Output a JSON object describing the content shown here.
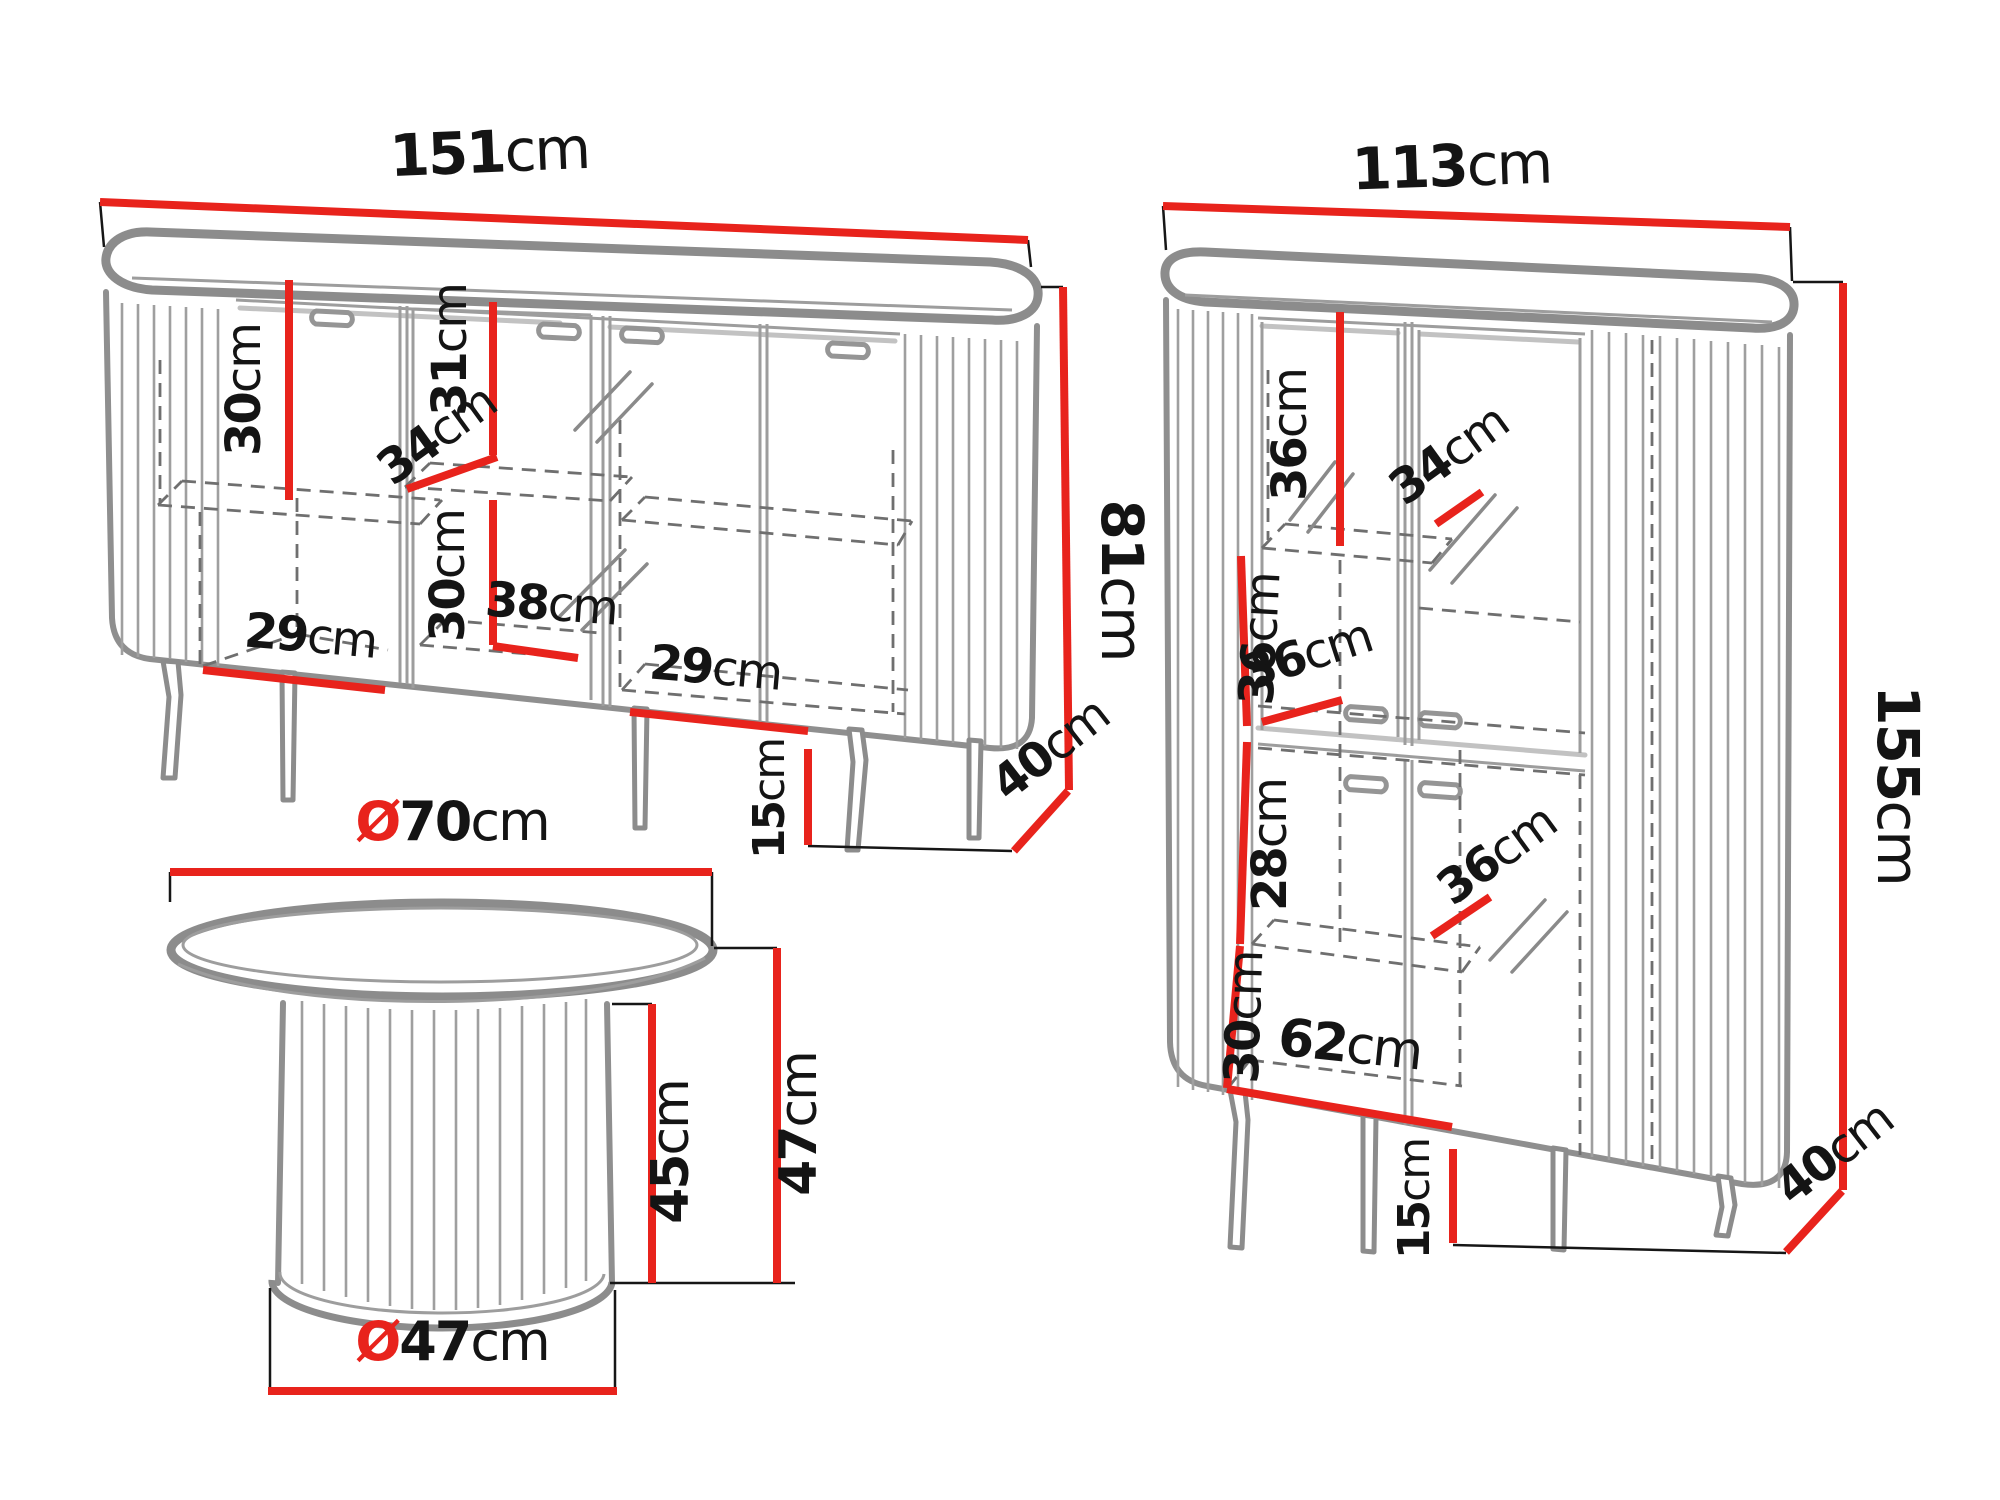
{
  "colors": {
    "dimension_red": "#e8231c",
    "furniture_gray": "#8c8c8c",
    "text_black": "#141414",
    "background": "#ffffff"
  },
  "pieces": {
    "sideboard": {
      "dims": {
        "width": {
          "value": "151",
          "unit": "cm"
        },
        "height": {
          "value": "81",
          "unit": "cm"
        },
        "leg_height": {
          "value": "15",
          "unit": "cm"
        },
        "depth": {
          "value": "40",
          "unit": "cm"
        },
        "left_inner_height": {
          "value": "30",
          "unit": "cm"
        },
        "left_inner_width": {
          "value": "29",
          "unit": "cm"
        },
        "mid_upper_height": {
          "value": "31",
          "unit": "cm"
        },
        "mid_shelf_depth": {
          "value": "34",
          "unit": "cm"
        },
        "mid_lower_height": {
          "value": "30",
          "unit": "cm"
        },
        "mid_lower_width": {
          "value": "38",
          "unit": "cm"
        },
        "right_inner_width": {
          "value": "29",
          "unit": "cm"
        }
      }
    },
    "highboard": {
      "dims": {
        "width": {
          "value": "113",
          "unit": "cm"
        },
        "height": {
          "value": "155",
          "unit": "cm"
        },
        "leg_height": {
          "value": "15",
          "unit": "cm"
        },
        "depth": {
          "value": "40",
          "unit": "cm"
        },
        "top_inner_height": {
          "value": "36",
          "unit": "cm"
        },
        "top_shelf_depth": {
          "value": "34",
          "unit": "cm"
        },
        "mid_inner_height": {
          "value": "36",
          "unit": "cm"
        },
        "mid_shelf_depth": {
          "value": "36",
          "unit": "cm"
        },
        "lower_inner_height": {
          "value": "28",
          "unit": "cm"
        },
        "lower_shelf_depth": {
          "value": "36",
          "unit": "cm"
        },
        "bottom_inner_height": {
          "value": "30",
          "unit": "cm"
        },
        "bottom_inner_width": {
          "value": "62",
          "unit": "cm"
        }
      }
    },
    "coffee_table": {
      "dims": {
        "top_diameter": {
          "prefix": "Ø",
          "value": "70",
          "unit": "cm"
        },
        "base_diameter": {
          "prefix": "Ø",
          "value": "47",
          "unit": "cm"
        },
        "pedestal_height": {
          "value": "45",
          "unit": "cm"
        },
        "total_height": {
          "value": "47",
          "unit": "cm"
        }
      }
    }
  }
}
